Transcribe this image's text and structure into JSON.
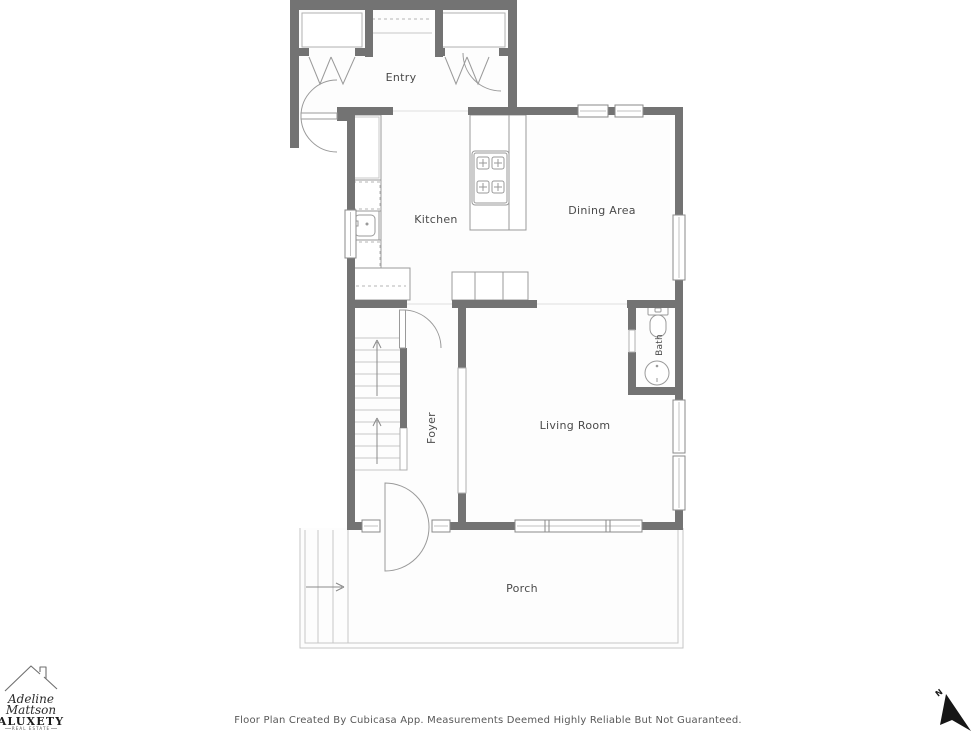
{
  "title": "Floor Plan",
  "colors": {
    "wall": "#737373",
    "fixture_outline": "#9a9a9a",
    "label_text": "#4a4a4a",
    "compass": "#1a1a1a"
  },
  "rooms": {
    "entry": {
      "label": "Entry"
    },
    "kitchen": {
      "label": "Kitchen"
    },
    "dining": {
      "label": "Dining Area"
    },
    "bath": {
      "label": "Bath"
    },
    "foyer": {
      "label": "Foyer"
    },
    "living": {
      "label": "Living Room"
    },
    "porch": {
      "label": "Porch"
    }
  },
  "footer": {
    "disclaimer": "Floor Plan Created By Cubicasa App. Measurements Deemed Highly Reliable But Not Guaranteed."
  },
  "logo": {
    "name_line1": "Adeline",
    "name_line2": "Mattson",
    "brand": "ALUXETY",
    "tagline": "REAL ESTATE"
  },
  "compass": {
    "north_label": "N"
  }
}
